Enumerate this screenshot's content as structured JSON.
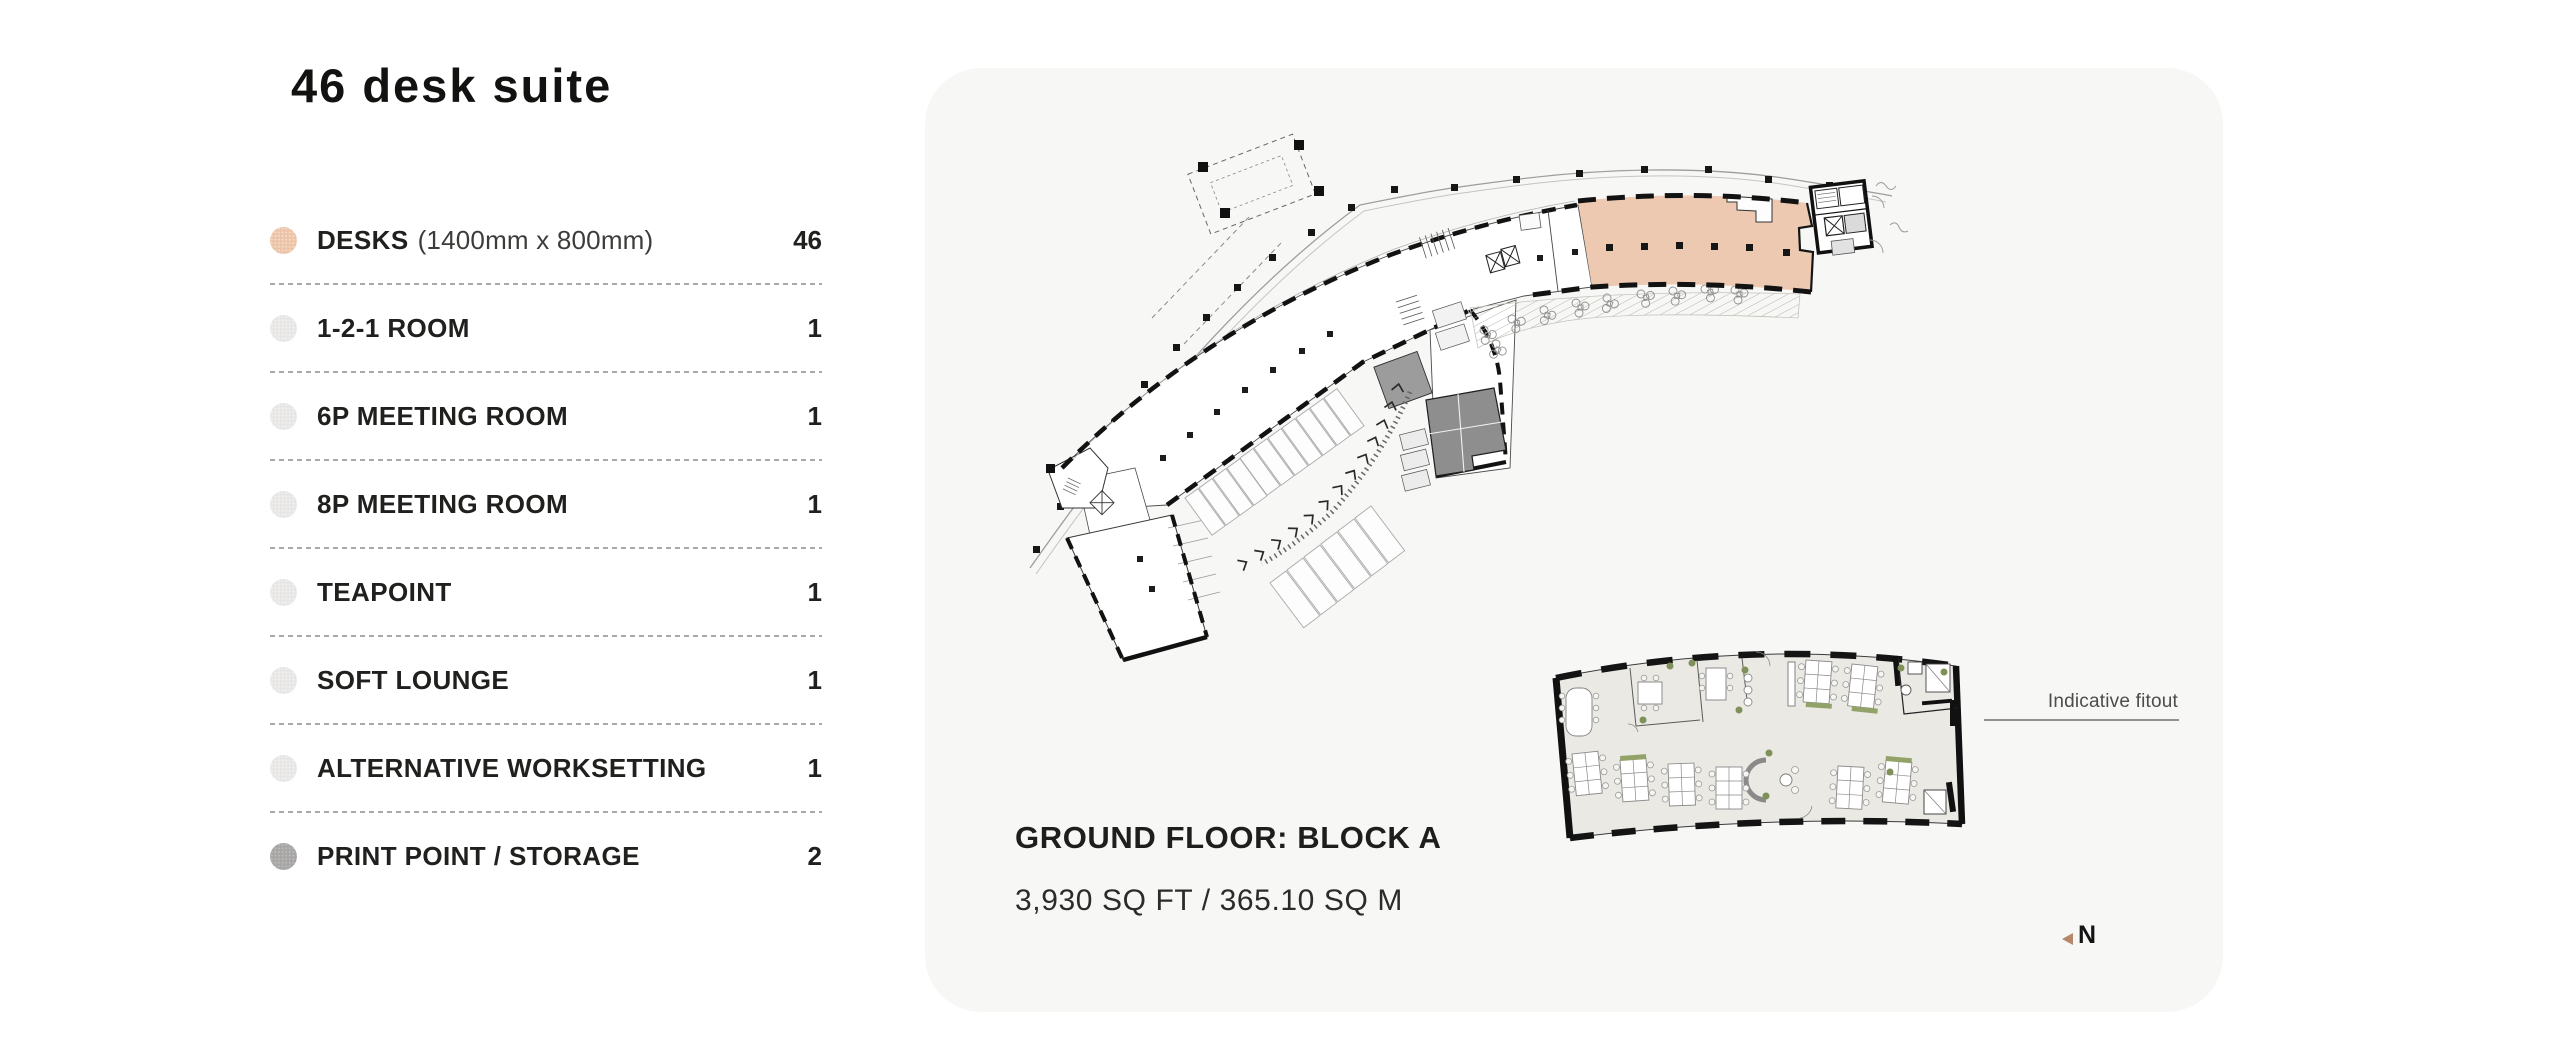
{
  "title": "46 desk suite",
  "legend": {
    "items": [
      {
        "name": "DESKS",
        "detail": "(1400mm x 800mm)",
        "count": "46",
        "dot_color": "#ecc3a6"
      },
      {
        "name": "1-2-1 ROOM",
        "detail": "",
        "count": "1",
        "dot_color": "#e7e6e5"
      },
      {
        "name": "6P MEETING ROOM",
        "detail": "",
        "count": "1",
        "dot_color": "#e7e6e5"
      },
      {
        "name": "8P MEETING ROOM",
        "detail": "",
        "count": "1",
        "dot_color": "#e7e6e5"
      },
      {
        "name": "TEAPOINT",
        "detail": "",
        "count": "1",
        "dot_color": "#e7e6e5"
      },
      {
        "name": "SOFT LOUNGE",
        "detail": "",
        "count": "1",
        "dot_color": "#e7e6e5"
      },
      {
        "name": "ALTERNATIVE WORKSETTING",
        "detail": "",
        "count": "1",
        "dot_color": "#e7e6e5"
      },
      {
        "name": "PRINT POINT / STORAGE",
        "detail": "",
        "count": "2",
        "dot_color": "#a7a6a5"
      }
    ]
  },
  "plan_panel": {
    "floor_label": "GROUND FLOOR: BLOCK A",
    "area_label": "3,930 SQ FT / 365.10 SQ M",
    "fitout_note": "Indicative fitout",
    "north_label": "N",
    "panel_background": "#f7f7f5",
    "suite_highlight_color": "#edc9b2",
    "storage_room_colors": [
      "#9c9c9c",
      "#8e8e8e"
    ],
    "fitout_floor_color": "#ebe9e4"
  }
}
